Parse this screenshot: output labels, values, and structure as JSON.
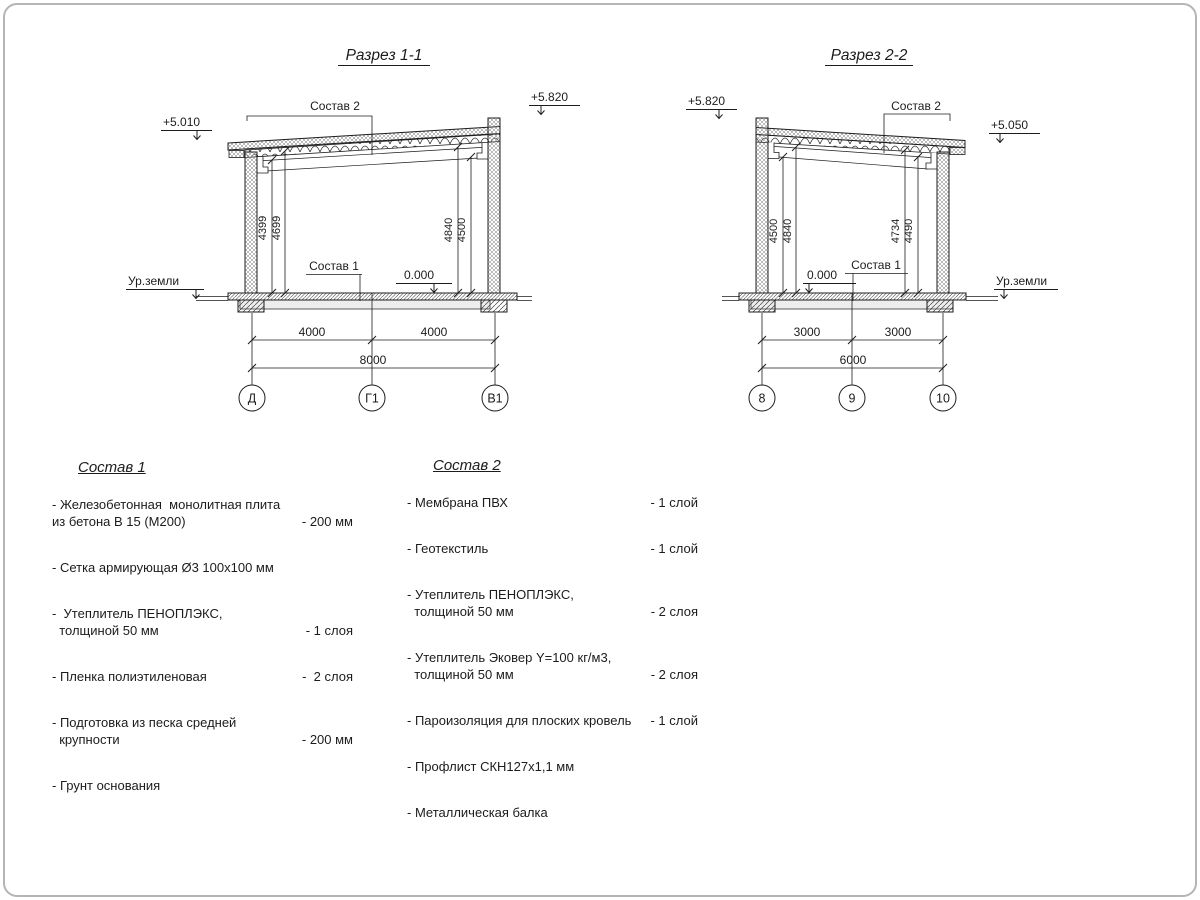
{
  "section1": {
    "title": "Разрез 1-1",
    "elev_left": "+5.010",
    "elev_right": "+5.820",
    "elev_floor": "0.000",
    "ground": "Ур.земли",
    "label_roof": "Состав 2",
    "label_floor": "Состав 1",
    "v_dims": [
      "4399",
      "4699",
      "4840",
      "4500"
    ],
    "spans": [
      "4000",
      "4000"
    ],
    "total": "8000",
    "axes": [
      "Д",
      "Г1",
      "В1"
    ]
  },
  "section2": {
    "title": "Разрез 2-2",
    "elev_left": "+5.820",
    "elev_right": "+5.050",
    "elev_floor": "0.000",
    "ground": "Ур.земли",
    "label_roof": "Состав 2",
    "label_floor": "Состав 1",
    "v_dims": [
      "4500",
      "4840",
      "4734",
      "4490"
    ],
    "spans": [
      "3000",
      "3000"
    ],
    "total": "6000",
    "axes": [
      "8",
      "9",
      "10"
    ]
  },
  "sostav1": {
    "title": "Состав 1",
    "items": [
      {
        "line1": "- Железобетонная  монолитная плита",
        "line2": "из бетона В 15 (М200)",
        "qty": "- 200 мм"
      },
      {
        "line1": "- Сетка армирующая Ø3 100х100 мм",
        "line2": "",
        "qty": ""
      },
      {
        "line1": "-  Утеплитель ПЕНОПЛЭКС,",
        "line2": "  толщиной 50 мм",
        "qty": "- 1 слоя"
      },
      {
        "line1": "- Пленка полиэтиленовая",
        "line2": "",
        "qty": "-  2 слоя"
      },
      {
        "line1": "- Подготовка из песка средней",
        "line2": "  крупности",
        "qty": "- 200 мм"
      },
      {
        "line1": "- Грунт основания",
        "line2": "",
        "qty": ""
      }
    ]
  },
  "sostav2": {
    "title": "Состав 2",
    "items": [
      {
        "line1": "- Мембрана ПВХ",
        "line2": "",
        "qty": "- 1 слой"
      },
      {
        "line1": "- Геотекстиль",
        "line2": "",
        "qty": "- 1 слой"
      },
      {
        "line1": "- Утеплитель ПЕНОПЛЭКС,",
        "line2": "  толщиной 50 мм",
        "qty": "- 2 слоя"
      },
      {
        "line1": "- Утеплитель Эковер Y=100 кг/м3,",
        "line2": "  толщиной 50 мм",
        "qty": "- 2 слоя"
      },
      {
        "line1": "- Пароизоляция для плоских кровель",
        "line2": "",
        "qty": "- 1 слой"
      },
      {
        "line1": "- Профлист СКН127х1,1 мм",
        "line2": "",
        "qty": ""
      },
      {
        "line1": "- Металлическая балка",
        "line2": "",
        "qty": ""
      }
    ]
  }
}
